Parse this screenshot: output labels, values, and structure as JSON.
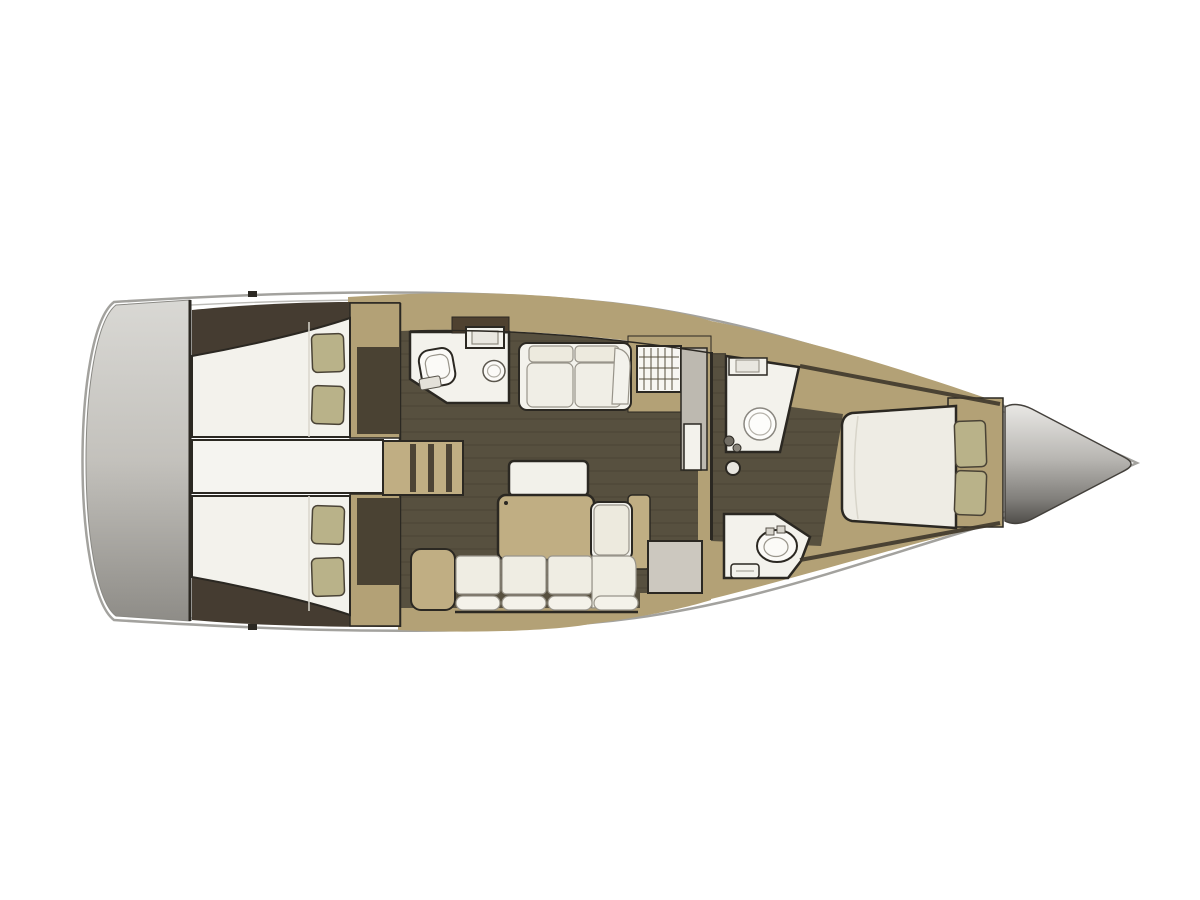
{
  "page": {
    "background": "#ffffff",
    "width": 1200,
    "height": 900
  },
  "diagram": {
    "type": "yacht-interior-floor-plan",
    "view": "top-down",
    "orientation": "bow-right-stern-left",
    "regions": [
      {
        "id": "swim-platform",
        "kind": "stern transom platform"
      },
      {
        "id": "aft-cabin-port",
        "kind": "aft double cabin with berth and two pillows"
      },
      {
        "id": "aft-cabin-starboard",
        "kind": "aft double cabin with berth and two pillows"
      },
      {
        "id": "companionway",
        "kind": "entry steps between aft cabins"
      },
      {
        "id": "aft-head",
        "kind": "aft bathroom with toilet and washbasin"
      },
      {
        "id": "saloon",
        "kind": "main salon with settee, table, sofa and chart seat"
      },
      {
        "id": "galley",
        "kind": "counter with sink, stove grid, cabinet and fridge"
      },
      {
        "id": "forward-head-shower",
        "kind": "forward shower room"
      },
      {
        "id": "forward-head-toilet",
        "kind": "forward bathroom with toilet and basin"
      },
      {
        "id": "forward-cabin",
        "kind": "owner cabin with island berth and two pillows"
      },
      {
        "id": "bow-locker",
        "kind": "anchor locker cone at bow"
      }
    ],
    "fixtures": [
      "toilet",
      "washbasin",
      "shower",
      "sink-counter",
      "stove-grid",
      "fridge",
      "mast-step",
      "table",
      "sofa",
      "settee",
      "steps"
    ]
  },
  "palette": {
    "hull_stroke": "#a3a29e",
    "deck_white": "#ffffff",
    "wood": "#b3a176",
    "wood_light": "#c0ae83",
    "floor_dark": "#57503f",
    "corner_dark": "#453c31",
    "wall_dark": "#2b2822",
    "furniture_white": "#f3f2ec",
    "cushion": "#edeade",
    "pillow": "#b9b289",
    "step_gray": "#ccc8bf",
    "transom_top": "#d9d8d4",
    "transom_bottom": "#8e8c87",
    "bow_light": "#e9e8e5",
    "bow_dark": "#504e4a"
  }
}
